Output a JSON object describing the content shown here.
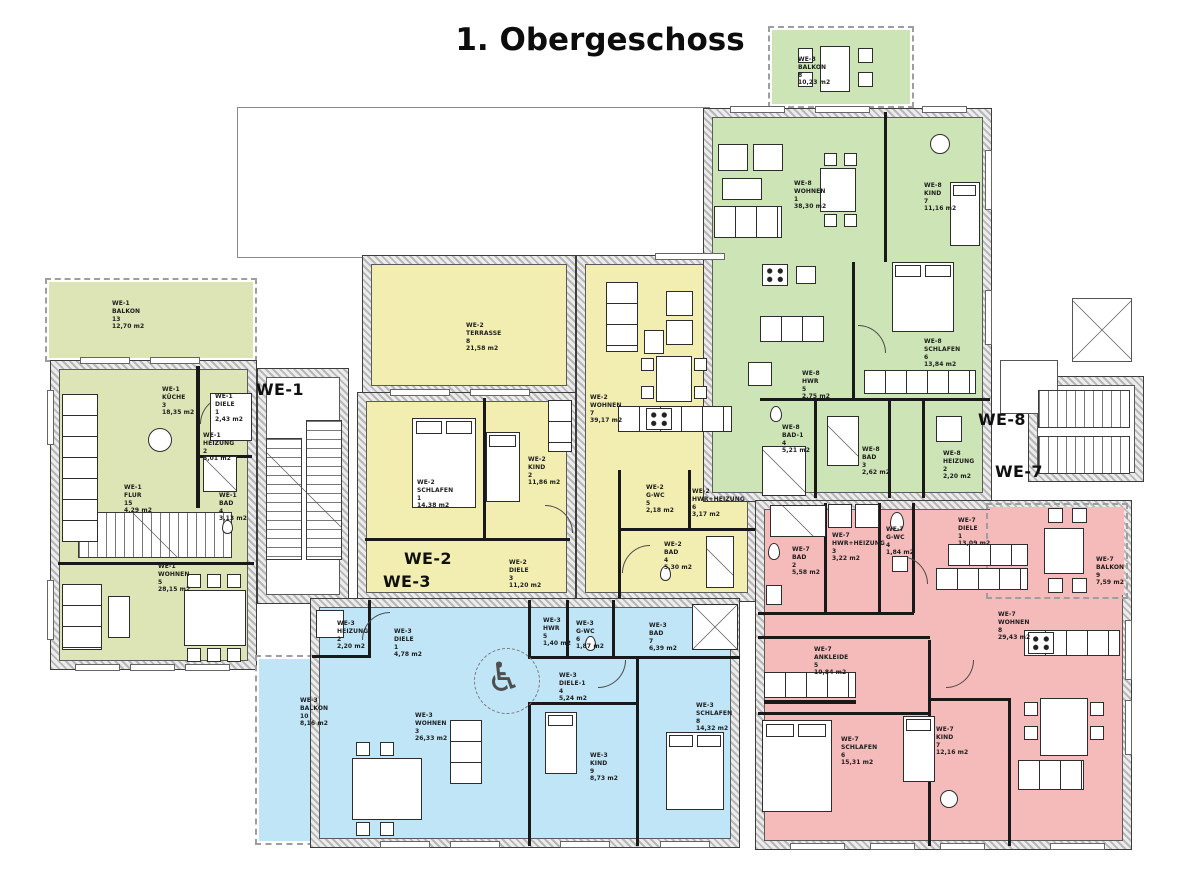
{
  "title": "1. Obergeschoss",
  "units": [
    {
      "id": "WE-1",
      "color": "#dde4b5"
    },
    {
      "id": "WE-2",
      "color": "#f2eeb2"
    },
    {
      "id": "WE-3",
      "color": "#bfe5f7"
    },
    {
      "id": "WE-7",
      "color": "#f5baba"
    },
    {
      "id": "WE-8",
      "color": "#cce4b6"
    }
  ],
  "stair_labels": {
    "left_top": "WE-1",
    "left_mid": "WE-2",
    "left_low": "WE-3",
    "right_top": "WE-8",
    "right_low": "WE-7"
  },
  "rooms": [
    {
      "unit": "WE-1",
      "name": "BALKON",
      "num": "13",
      "area": "12,70 m2"
    },
    {
      "unit": "WE-1",
      "name": "KÜCHE",
      "num": "3",
      "area": "18,35 m2"
    },
    {
      "unit": "WE-1",
      "name": "DIELE",
      "num": "1",
      "area": "2,43 m2"
    },
    {
      "unit": "WE-1",
      "name": "HEIZUNG",
      "num": "2",
      "area": "5,01 m2"
    },
    {
      "unit": "WE-1",
      "name": "BAD",
      "num": "4",
      "area": "3,13 m2"
    },
    {
      "unit": "WE-1",
      "name": "FLUR",
      "num": "15",
      "area": "4,29 m2"
    },
    {
      "unit": "WE-1",
      "name": "WOHNEN",
      "num": "5",
      "area": "28,15 m2"
    },
    {
      "unit": "WE-2",
      "name": "TERRASSE",
      "num": "8",
      "area": "21,58 m2"
    },
    {
      "unit": "WE-2",
      "name": "WOHNEN",
      "num": "7",
      "area": "39,17 m2"
    },
    {
      "unit": "WE-2",
      "name": "SCHLAFEN",
      "num": "1",
      "area": "14,38 m2"
    },
    {
      "unit": "WE-2",
      "name": "KIND",
      "num": "2",
      "area": "11,86 m2"
    },
    {
      "unit": "WE-2",
      "name": "G-WC",
      "num": "5",
      "area": "2,18 m2"
    },
    {
      "unit": "WE-2",
      "name": "HWR+HEIZUNG",
      "num": "6",
      "area": "3,17 m2"
    },
    {
      "unit": "WE-2",
      "name": "BAD",
      "num": "4",
      "area": "5,30 m2"
    },
    {
      "unit": "WE-2",
      "name": "DIELE",
      "num": "3",
      "area": "11,20 m2"
    },
    {
      "unit": "WE-3",
      "name": "HEIZUNG",
      "num": "2",
      "area": "2,20 m2"
    },
    {
      "unit": "WE-3",
      "name": "DIELE",
      "num": "1",
      "area": "4,78 m2"
    },
    {
      "unit": "WE-3",
      "name": "HWR",
      "num": "5",
      "area": "1,40 m2"
    },
    {
      "unit": "WE-3",
      "name": "G-WC",
      "num": "6",
      "area": "1,87 m2"
    },
    {
      "unit": "WE-3",
      "name": "BAD",
      "num": "7",
      "area": "6,39 m2"
    },
    {
      "unit": "WE-3",
      "name": "DIELE-1",
      "num": "4",
      "area": "5,24 m2"
    },
    {
      "unit": "WE-3",
      "name": "BALKON",
      "num": "10",
      "area": "8,16 m2"
    },
    {
      "unit": "WE-3",
      "name": "WOHNEN",
      "num": "3",
      "area": "26,33 m2"
    },
    {
      "unit": "WE-3",
      "name": "KIND",
      "num": "9",
      "area": "8,73 m2"
    },
    {
      "unit": "WE-3",
      "name": "SCHLAFEN",
      "num": "8",
      "area": "14,32 m2"
    },
    {
      "unit": "WE-8",
      "name": "BALKON",
      "num": "8",
      "area": "10,23 m2"
    },
    {
      "unit": "WE-8",
      "name": "WOHNEN",
      "num": "1",
      "area": "38,30 m2"
    },
    {
      "unit": "WE-8",
      "name": "KIND",
      "num": "7",
      "area": "11,16 m2"
    },
    {
      "unit": "WE-8",
      "name": "SCHLAFEN",
      "num": "6",
      "area": "13,84 m2"
    },
    {
      "unit": "WE-8",
      "name": "HWR",
      "num": "5",
      "area": "2,75 m2"
    },
    {
      "unit": "WE-8",
      "name": "BAD-1",
      "num": "4",
      "area": "5,21 m2"
    },
    {
      "unit": "WE-8",
      "name": "BAD",
      "num": "3",
      "area": "2,62 m2"
    },
    {
      "unit": "WE-8",
      "name": "HEIZUNG",
      "num": "2",
      "area": "2,20 m2"
    },
    {
      "unit": "WE-7",
      "name": "BAD",
      "num": "2",
      "area": "5,58 m2"
    },
    {
      "unit": "WE-7",
      "name": "HWR+HEIZUNG",
      "num": "3",
      "area": "3,22 m2"
    },
    {
      "unit": "WE-7",
      "name": "G-WC",
      "num": "4",
      "area": "1,84 m2"
    },
    {
      "unit": "WE-7",
      "name": "DIELE",
      "num": "1",
      "area": "13,09 m2"
    },
    {
      "unit": "WE-7",
      "name": "BALKON",
      "num": "9",
      "area": "7,59 m2"
    },
    {
      "unit": "WE-7",
      "name": "WOHNEN",
      "num": "8",
      "area": "29,43 m2"
    },
    {
      "unit": "WE-7",
      "name": "ANKLEIDE",
      "num": "5",
      "area": "10,84 m2"
    },
    {
      "unit": "WE-7",
      "name": "SCHLAFEN",
      "num": "6",
      "area": "15,31 m2"
    },
    {
      "unit": "WE-7",
      "name": "KIND",
      "num": "7",
      "area": "12,16 m2"
    }
  ],
  "icons": {
    "wheelchair": "♿"
  }
}
